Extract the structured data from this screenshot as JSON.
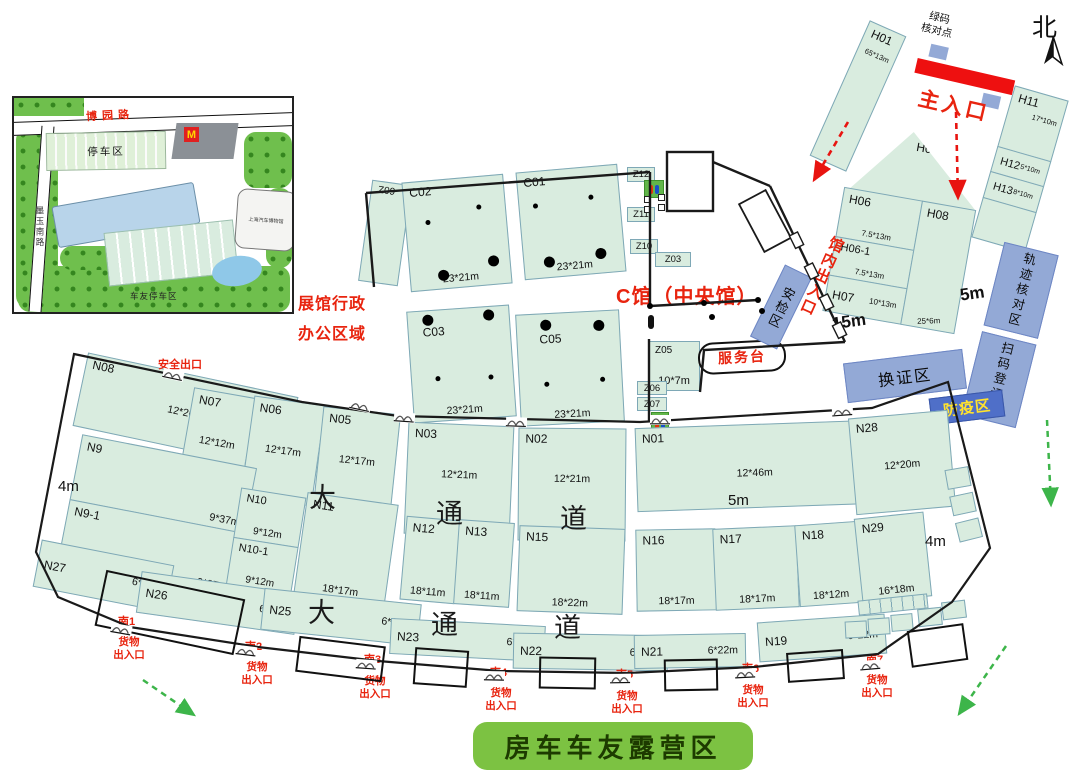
{
  "compass": "北",
  "entrance": {
    "main": "主入口",
    "cp1": "绿码",
    "cp2": "核对点"
  },
  "zones": {
    "central": "C馆（中央馆）",
    "service_desk": "服务台",
    "security": "安检区",
    "inner_entrance": "馆内出入口",
    "safety_exit": "安全出口",
    "badge": "换证区",
    "epidemic": "防疫区",
    "track": "轨迹核对区",
    "scan": "扫码登记区",
    "admin1": "展馆行政",
    "admin2": "办公区域",
    "camp": "房车车友露营区"
  },
  "measures": {
    "m15": "15m",
    "m5a": "5m",
    "m5b": "5m",
    "m4a": "4m",
    "m4b": "4m"
  },
  "passage_upper": [
    "大",
    "通",
    "道"
  ],
  "passage_lower": [
    "大",
    "通",
    "道"
  ],
  "gates": {
    "cargo1": "货物",
    "cargo2": "出入口",
    "list": [
      {
        "id": "南1"
      },
      {
        "id": "南2"
      },
      {
        "id": "南3"
      },
      {
        "id": "南4"
      },
      {
        "id": "南5"
      },
      {
        "id": "南6"
      },
      {
        "id": "南7"
      }
    ]
  },
  "halls": {
    "H01": {
      "label": "H01",
      "size": "65*13m"
    },
    "H05": {
      "label": "H05"
    },
    "H06": {
      "label": "H06",
      "size": "7.5*13m"
    },
    "H06_1": {
      "label": "H06-1",
      "size": "7.5*13m"
    },
    "H07": {
      "label": "H07",
      "size": "10*13m"
    },
    "H08": {
      "label": "H08",
      "size": "25*6m"
    },
    "H11": {
      "label": "H11",
      "size": "17*10m"
    },
    "H12": {
      "label": "H12",
      "size": "5*10m"
    },
    "H13": {
      "label": "H13",
      "size": "8*10m"
    },
    "C01": {
      "label": "C01",
      "size": "23*21m"
    },
    "C02": {
      "label": "C02",
      "size": "23*21m"
    },
    "C03": {
      "label": "C03",
      "size": "23*21m"
    },
    "C05": {
      "label": "C05",
      "size": "23*21m"
    },
    "N08": {
      "label": "N08",
      "size": "12*20m"
    },
    "N07": {
      "label": "N07",
      "size": "12*12m"
    },
    "N06": {
      "label": "N06",
      "size": "12*17m"
    },
    "N05": {
      "label": "N05",
      "size": "12*17m"
    },
    "N03": {
      "label": "N03",
      "size": "12*21m"
    },
    "N02": {
      "label": "N02",
      "size": "12*21m"
    },
    "N01": {
      "label": "N01",
      "size": "12*46m"
    },
    "N28": {
      "label": "N28",
      "size": "12*20m"
    },
    "N9": {
      "label": "N9",
      "size": "9*37m"
    },
    "N9_1": {
      "label": "N9-1",
      "size": "9*37m"
    },
    "N10": {
      "label": "N10",
      "size": "9*12m"
    },
    "N10_1": {
      "label": "N10-1",
      "size": "9*12m"
    },
    "N11": {
      "label": "N11",
      "size": "18*17m"
    },
    "N12": {
      "label": "N12",
      "size": "18*11m"
    },
    "N13": {
      "label": "N13",
      "size": "18*11m"
    },
    "N15": {
      "label": "N15",
      "size": "18*22m"
    },
    "N16": {
      "label": "N16",
      "size": "18*17m"
    },
    "N17": {
      "label": "N17",
      "size": "18*17m"
    },
    "N18": {
      "label": "N18",
      "size": "18*12m"
    },
    "N29": {
      "label": "N29",
      "size": "16*18m"
    },
    "N27": {
      "label": "N27",
      "size": "6*18m"
    },
    "N26": {
      "label": "N26",
      "size": "6*22m"
    },
    "N25": {
      "label": "N25",
      "size": "6*22m"
    },
    "N23": {
      "label": "N23",
      "size": "6*22m"
    },
    "N22": {
      "label": "N22",
      "size": "6*22m"
    },
    "N21": {
      "label": "N21",
      "size": "6*22m"
    },
    "N19": {
      "label": "N19",
      "size": "6*22m"
    },
    "Z03": {
      "label": "Z03"
    },
    "Z05": {
      "label": "Z05",
      "size": "10*7m"
    },
    "Z06": {
      "label": "Z06"
    },
    "Z07": {
      "label": "Z07"
    },
    "Z09": {
      "label": "Z09"
    },
    "Z10": {
      "label": "Z10"
    },
    "Z11": {
      "label": "Z11"
    },
    "Z12": {
      "label": "Z12"
    }
  },
  "inset": {
    "road_top": "博园路",
    "road_left": "墨玉南路",
    "parking": "停车区",
    "museum": "上海汽车博物馆",
    "camp_parking": "车友停车区",
    "mc": "M"
  }
}
